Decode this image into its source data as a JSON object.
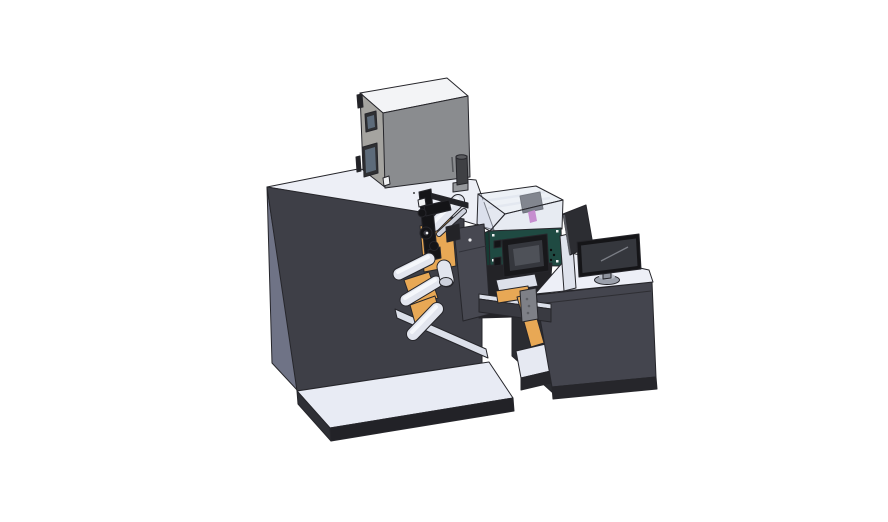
{
  "scene": {
    "title": "Isometric 3D CAD rendering of an industrial roll-label printing machine: main cabinet on base platform, top-mounted control box, web rollers with orange label stock, inkjet print unit with touchscreen under a translucent cover, and an operator desk with monitor",
    "background": "#FFFFFF",
    "canvas_width": "888",
    "canvas_height": "522"
  },
  "components": {
    "base_platform": "base platform",
    "main_cabinet": "main machine cabinet",
    "control_box": "top-mounted control box",
    "supply_cylinder": "supply cylinder",
    "web_mechanism": "web rollers and print head",
    "print_unit": "inkjet print unit with touchscreen",
    "lower_stand": "rewind stand shelf",
    "output_arm": "output web arm",
    "operator_desk": "operator console desk",
    "monitor": "desktop monitor",
    "rear_panel": "secondary display panel"
  },
  "colors": {
    "background": "#FFFFFF",
    "edge": "#26262B",
    "cabinet_top": "#EDEFF6",
    "cabinet_side": "#6F7386",
    "cabinet_front": "#3E3F47",
    "white_rail": "#DCE0EA",
    "platform_top": "#E8EBF4",
    "platform_side": "#2E2F35",
    "platform_front": "#222227",
    "box_top": "#F3F4F6",
    "box_side": "#A5A4A0",
    "box_front": "#8A8C8F",
    "box_window": "#2F3033",
    "box_window_inner": "#5D6B7A",
    "white_mark": "#F0F1F3",
    "vent": "#54565A",
    "cyl_body": "#3F4044",
    "cyl_top": "#5A5B5F",
    "cyl_base": "#96989C",
    "roller": "#E2E5EE",
    "roller_hilite": "#F5F7FB",
    "roller_cap": "#CDD1DC",
    "orange": "#E8A855",
    "black_part": "#141417",
    "dark_part": "#232327",
    "gear_inner": "#3C3C44",
    "plate": "#474851",
    "plate_dot": "#E9E9EC",
    "plate_seam": "#31323A",
    "teal_front": "#1F4A42",
    "teal_side": "#163A33",
    "cover": "#C9D2E2",
    "cover_top": "#D8DFEC",
    "rail_inner": "#EDEFF4",
    "carriage": "#3C3D44",
    "magenta": "#C455BF",
    "bezel": "#18181B",
    "screen": "#35373D",
    "screen_hilite": "#4E5158",
    "dot_dark": "#0C0C0C",
    "stand_dark": "#2B2C31",
    "shelf_white": "#E6E9F2",
    "desk_front": "#44454E",
    "desk_top": "#EDEFF7",
    "desk_seam": "#2E2E33",
    "plinth": "#26262B",
    "beam": "#393A41",
    "bracket": "#7E8087",
    "bracket_dot": "#5E6066",
    "mount_plate": "#DEE2EC",
    "panel_rear": "#2C2D32",
    "panel_edge": "#595B62",
    "monitor_frame": "#151518",
    "monitor_screen": "#35373D",
    "monitor_line": "#7A7D85",
    "stand_gray": "#9BA0AB",
    "stand_gray_light": "#B8BCC6",
    "stand_neck": "#8E929C"
  }
}
